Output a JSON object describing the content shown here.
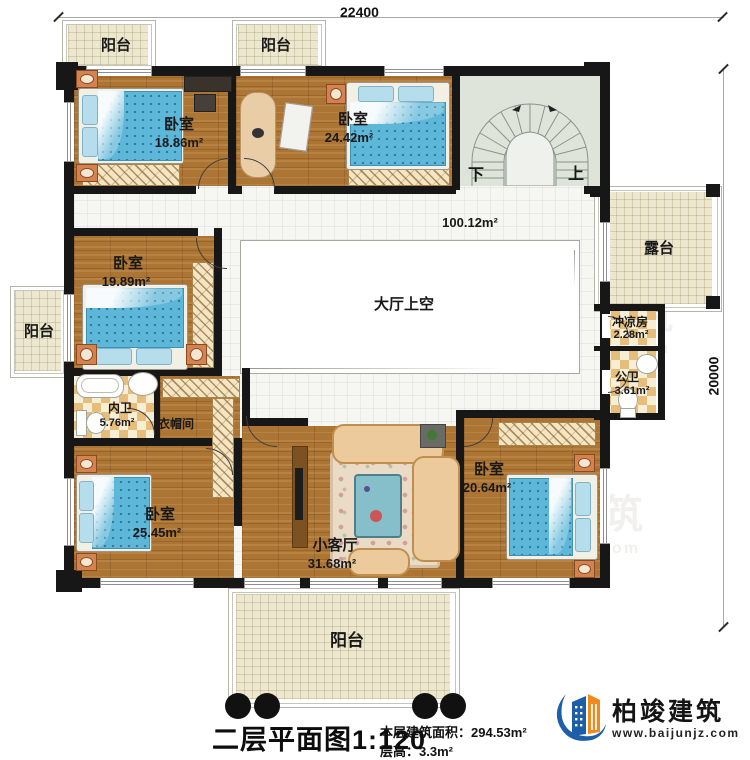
{
  "title_block": {
    "title": "二层平面图1:120",
    "area_line": "本层建筑面积：294.53m²",
    "height_line": "层高：3.3m²"
  },
  "dimensions": {
    "width_mm": "22400",
    "height_mm": "20000"
  },
  "rooms": {
    "bedroom1": {
      "name": "卧室",
      "area": "18.86m²"
    },
    "bedroom2": {
      "name": "卧室",
      "area": "24.42m²"
    },
    "bedroom3": {
      "name": "卧室",
      "area": "19.89m²"
    },
    "bedroom4": {
      "name": "卧室",
      "area": "25.45m²"
    },
    "bedroom5": {
      "name": "卧室",
      "area": "20.64m²"
    },
    "living_room": {
      "name": "小客厅",
      "area": "31.68m²"
    },
    "ensuite_bath": {
      "name": "内卫",
      "area": "5.76m²"
    },
    "closet": {
      "name": "衣帽间"
    },
    "shower_room": {
      "name": "冲凉房",
      "area": "2.28m²"
    },
    "public_bath": {
      "name": "公卫",
      "area": "3.61m²"
    },
    "terrace": {
      "name": "露台"
    },
    "hall_void": {
      "name": "大厅上空"
    },
    "landing_area": {
      "area": "100.12m²"
    },
    "balcony": {
      "name": "阳台"
    }
  },
  "stairs": {
    "down_label": "下",
    "up_label": "上"
  },
  "brand": {
    "name": "柏竣建筑",
    "website": "www.baijunjz.com"
  },
  "watermark": {
    "name": "柏竣建筑",
    "website": "www.baijunjz.com"
  },
  "colors": {
    "wall": "#171717",
    "wood_floor": "#ad7533",
    "balcony_cream": "#ede7cf",
    "stair_floor": "#dfe4da",
    "bath_checker": "#e6bd7a",
    "bed_blue": "#5db7d9",
    "sofa_tan": "#edca9c",
    "brand_blue": "#1c5fa8",
    "brand_orange": "#f0891e"
  }
}
